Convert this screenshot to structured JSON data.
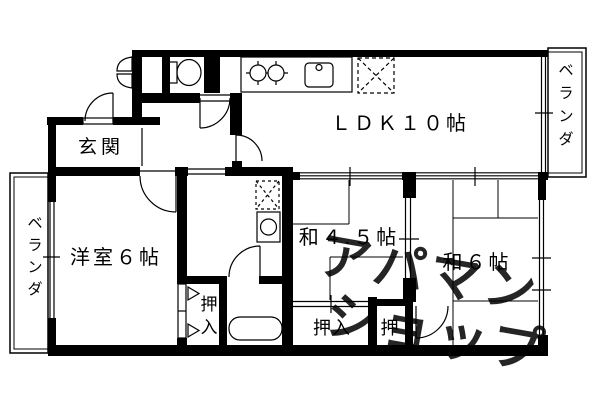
{
  "title": "apartment-floorplan",
  "colors": {
    "wall": "#000000",
    "background": "#ffffff",
    "watermark": "#c8c8c8"
  },
  "rooms": {
    "entrance": {
      "label": "玄関"
    },
    "ldk": {
      "label": "ＬＤＫ１０帖"
    },
    "western_room": {
      "label": "洋室６帖"
    },
    "japanese_room_4_5": {
      "label": "和４.５帖"
    },
    "japanese_room_6": {
      "label": "和６帖"
    }
  },
  "closets": {
    "western_room_closet": {
      "label": "押入"
    },
    "japanese_room_4_5_closet": {
      "label": "押入"
    },
    "japanese_room_6_closet": {
      "label": "押"
    }
  },
  "verandas": {
    "left": {
      "label": "ベランダ"
    },
    "right": {
      "label": "ベランダ"
    }
  },
  "watermark": {
    "line1": "アパマン",
    "line2": "ショップ"
  },
  "icons": [
    "toilet-icon",
    "folding-door-icon",
    "gas-stove-icon",
    "kitchen-sink-icon",
    "refrigerator-space-icon",
    "washer-space-icon",
    "washing-machine-icon",
    "bathtub-icon",
    "door-swing-icon",
    "sliding-door-icon",
    "window-icon"
  ]
}
